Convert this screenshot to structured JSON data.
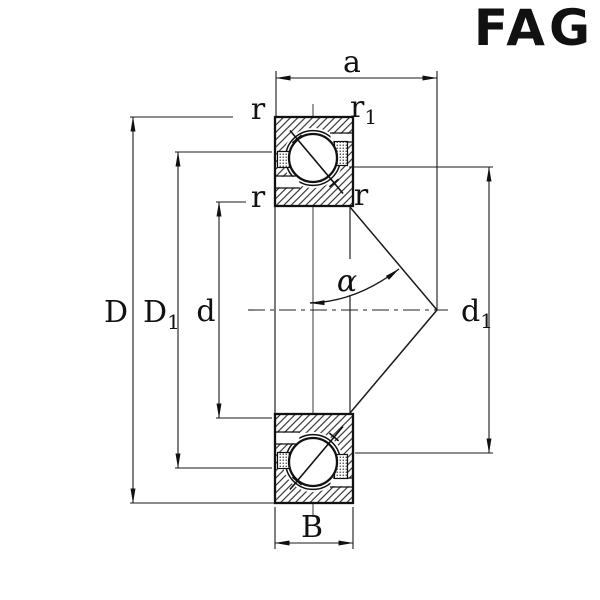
{
  "brand": {
    "name": "FAG",
    "color": "#d2122b"
  },
  "colors": {
    "ink": "#1a1a1a",
    "background": "#ffffff"
  },
  "drawing": {
    "labels": {
      "a": "a",
      "D": "D",
      "D1_base": "D",
      "D1_sub": "1",
      "d": "d",
      "d1_base": "d",
      "d1_sub": "1",
      "B": "B",
      "alpha": "α",
      "r_top_left": "r",
      "r1_base": "r",
      "r1_sub": "1",
      "r_mid_left": "r",
      "r_mid_right": "r"
    }
  }
}
